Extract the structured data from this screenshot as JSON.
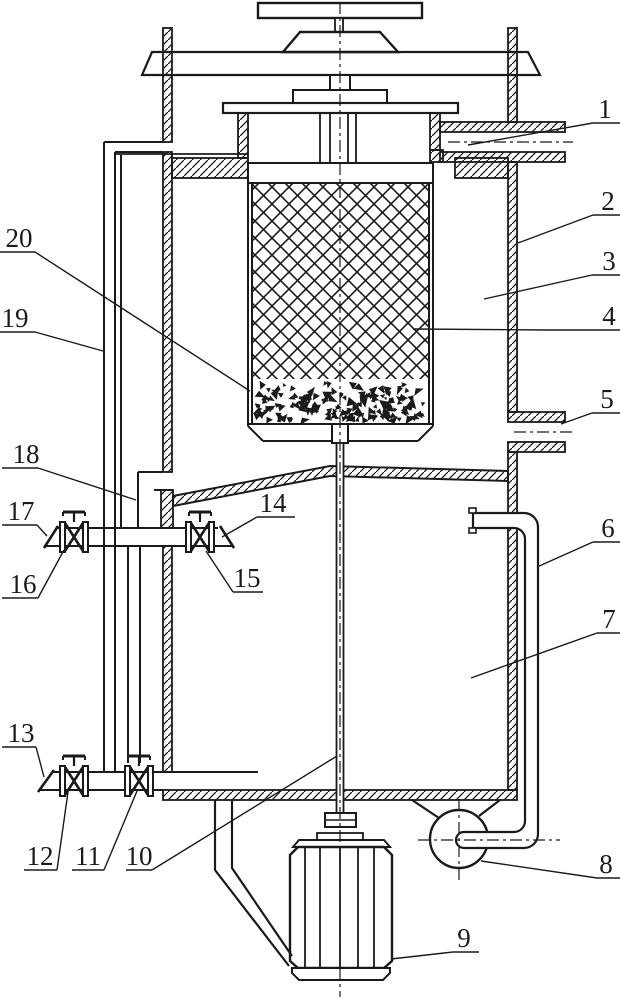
{
  "figure": {
    "background": "#ffffff",
    "line_color": "#1a1a1a",
    "callouts": [
      {
        "label": "1",
        "tx": 605,
        "ty": 118,
        "ul": [
          593,
          123,
          620,
          123
        ],
        "ld": [
          593,
          123,
          468,
          145
        ]
      },
      {
        "label": "2",
        "tx": 608,
        "ty": 210,
        "ul": [
          593,
          215,
          620,
          215
        ],
        "ld": [
          593,
          215,
          518,
          243
        ]
      },
      {
        "label": "3",
        "tx": 609,
        "ty": 270,
        "ul": [
          592,
          275,
          620,
          275
        ],
        "ld": [
          592,
          275,
          484,
          299
        ]
      },
      {
        "label": "4",
        "tx": 609,
        "ty": 325,
        "ul": [
          547,
          330,
          620,
          330
        ],
        "ld": [
          547,
          330,
          413,
          329
        ]
      },
      {
        "label": "5",
        "tx": 607,
        "ty": 408,
        "ul": [
          592,
          413,
          620,
          413
        ],
        "ld": [
          592,
          413,
          561,
          424
        ]
      },
      {
        "label": "6",
        "tx": 608,
        "ty": 537,
        "ul": [
          593,
          542,
          620,
          542
        ],
        "ld": [
          593,
          542,
          537,
          567
        ]
      },
      {
        "label": "7",
        "tx": 609,
        "ty": 628,
        "ul": [
          597,
          633,
          620,
          633
        ],
        "ld": [
          597,
          633,
          471,
          678
        ]
      },
      {
        "label": "8",
        "tx": 606,
        "ty": 873,
        "ul": [
          597,
          878,
          620,
          878
        ],
        "ld": [
          597,
          878,
          481,
          861
        ]
      },
      {
        "label": "9",
        "tx": 464,
        "ty": 947,
        "ul": [
          453,
          952,
          479,
          952
        ],
        "ld": [
          453,
          952,
          391,
          959
        ]
      },
      {
        "label": "10",
        "tx": 139,
        "ty": 865,
        "ul": [
          126,
          870,
          152,
          870
        ],
        "ld": [
          152,
          870,
          337,
          756
        ]
      },
      {
        "label": "11",
        "tx": 88,
        "ty": 865,
        "ul": [
          72,
          870,
          104,
          870
        ],
        "ld": [
          104,
          870,
          137,
          791
        ]
      },
      {
        "label": "12",
        "tx": 40,
        "ty": 865,
        "ul": [
          24,
          870,
          57,
          870
        ],
        "ld": [
          57,
          870,
          68,
          792
        ]
      },
      {
        "label": "13",
        "tx": 21,
        "ty": 742,
        "ul": [
          2,
          747,
          36,
          747
        ],
        "ld": [
          36,
          747,
          44,
          777
        ]
      },
      {
        "label": "14",
        "tx": 273,
        "ty": 512,
        "ul": [
          257,
          517,
          295,
          517
        ],
        "ld": [
          257,
          517,
          222,
          537
        ]
      },
      {
        "label": "15",
        "tx": 247,
        "ty": 587,
        "ul": [
          233,
          592,
          263,
          592
        ],
        "ld": [
          233,
          592,
          206,
          551
        ]
      },
      {
        "label": "16",
        "tx": 23,
        "ty": 593,
        "ul": [
          2,
          598,
          38,
          598
        ],
        "ld": [
          38,
          598,
          64,
          550
        ]
      },
      {
        "label": "17",
        "tx": 21,
        "ty": 520,
        "ul": [
          2,
          525,
          37,
          525
        ],
        "ld": [
          37,
          525,
          47,
          536
        ]
      },
      {
        "label": "18",
        "tx": 26,
        "ty": 463,
        "ul": [
          2,
          468,
          38,
          468
        ],
        "ld": [
          38,
          468,
          136,
          500
        ]
      },
      {
        "label": "19",
        "tx": 15,
        "ty": 327,
        "ul": [
          0,
          332,
          35,
          332
        ],
        "ld": [
          35,
          332,
          103,
          351
        ]
      },
      {
        "label": "20",
        "tx": 19,
        "ty": 247,
        "ul": [
          0,
          252,
          35,
          252
        ],
        "ld": [
          35,
          252,
          250,
          391
        ]
      }
    ]
  }
}
